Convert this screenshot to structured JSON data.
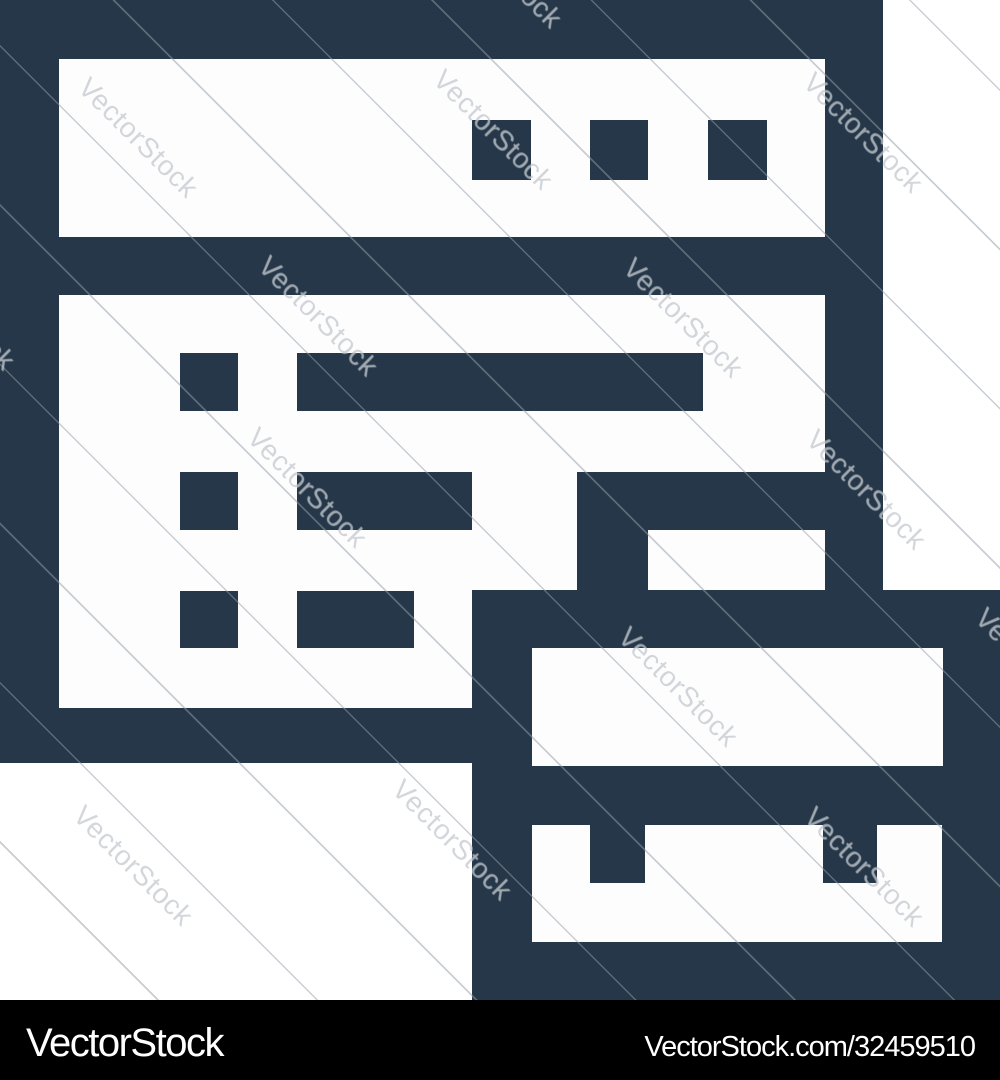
{
  "image": {
    "description": "Dark navy outline icon of a browser window with content rows and a server block",
    "icon_semantic": "browser-server-icon",
    "colors": {
      "icon_navy": "#253748",
      "canvas_white": "#ffffff",
      "footer_black": "#000000",
      "footer_text": "#ffffff"
    }
  },
  "watermark": {
    "text": "VectorStock",
    "instances": [
      {
        "x": 138,
        "y": 138
      },
      {
        "x": 493,
        "y": 130
      },
      {
        "x": 863,
        "y": 133
      },
      {
        "x": -45,
        "y": 310
      },
      {
        "x": 318,
        "y": 316
      },
      {
        "x": 683,
        "y": 318
      },
      {
        "x": 1035,
        "y": 668
      },
      {
        "x": 307,
        "y": 488
      },
      {
        "x": 866,
        "y": 490
      },
      {
        "x": 133,
        "y": 866
      },
      {
        "x": 678,
        "y": 687
      },
      {
        "x": 864,
        "y": 867
      },
      {
        "x": 452,
        "y": 840
      },
      {
        "x": 502,
        "y": -32
      }
    ]
  },
  "footer": {
    "brand": "VectorStock",
    "credit": "VectorStock.com/32459510"
  }
}
